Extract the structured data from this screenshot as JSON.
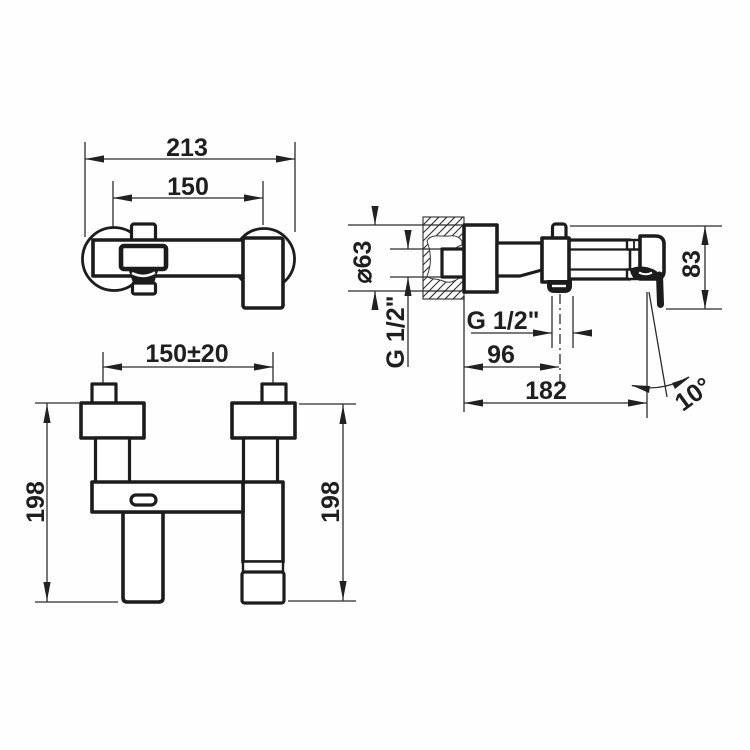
{
  "dims": {
    "front": {
      "overall_width": "213",
      "hole_centers": "150"
    },
    "side": {
      "flange_diameter": "⌀63",
      "wall_thread": "G 1/2\"",
      "outlet_thread": "G 1/2\"",
      "outlet_distance": "96",
      "overall_depth": "182",
      "body_height": "83",
      "handle_angle": "10°"
    },
    "bottom": {
      "hole_centers": "150±20",
      "height_left": "198",
      "height_right": "198"
    }
  }
}
